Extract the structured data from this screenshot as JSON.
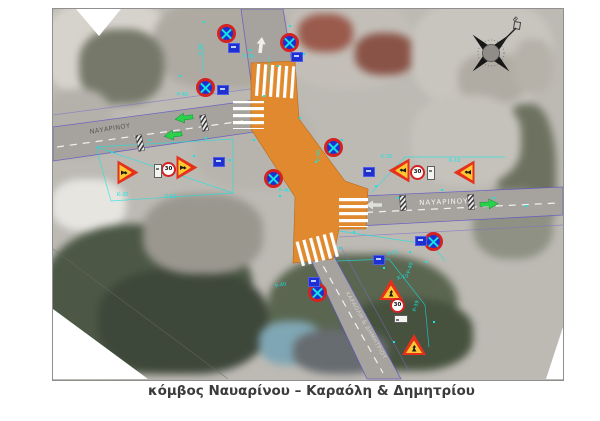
{
  "figure": {
    "caption": "κόμβος Ναυαρίνου – Καραόλη & Δημητρίου"
  },
  "map": {
    "streets": {
      "navarinou_west": "ΝΑΥΑΡΙΝΟΥ",
      "navarinou_east": "ΝΑΥΑΡΙΝΟΥ",
      "karaoli": "ΚΑΡΑΟΛΗ & ΔΗΜΗΤΡΙΟΥ"
    },
    "compass": {
      "north_label": "B"
    },
    "speed_limit": "30",
    "sign_codes": [
      "Ρ-40",
      "Ρ-39",
      "Ρ-40",
      "Ρ-40",
      "Ρ-40",
      "Κ-20",
      "Ρ-52",
      "Κ-20",
      "Κ-10",
      "Ρ-21",
      "Ρ-40",
      "Κ-10",
      "Ρ-39",
      "Ρ-40"
    ],
    "colors": {
      "work_zone": "#e0892f",
      "sign_red": "#d42222",
      "sign_blue": "#2030d0",
      "annotation_cyan": "#12e4e4",
      "arrow_green": "#2ad24b"
    }
  }
}
